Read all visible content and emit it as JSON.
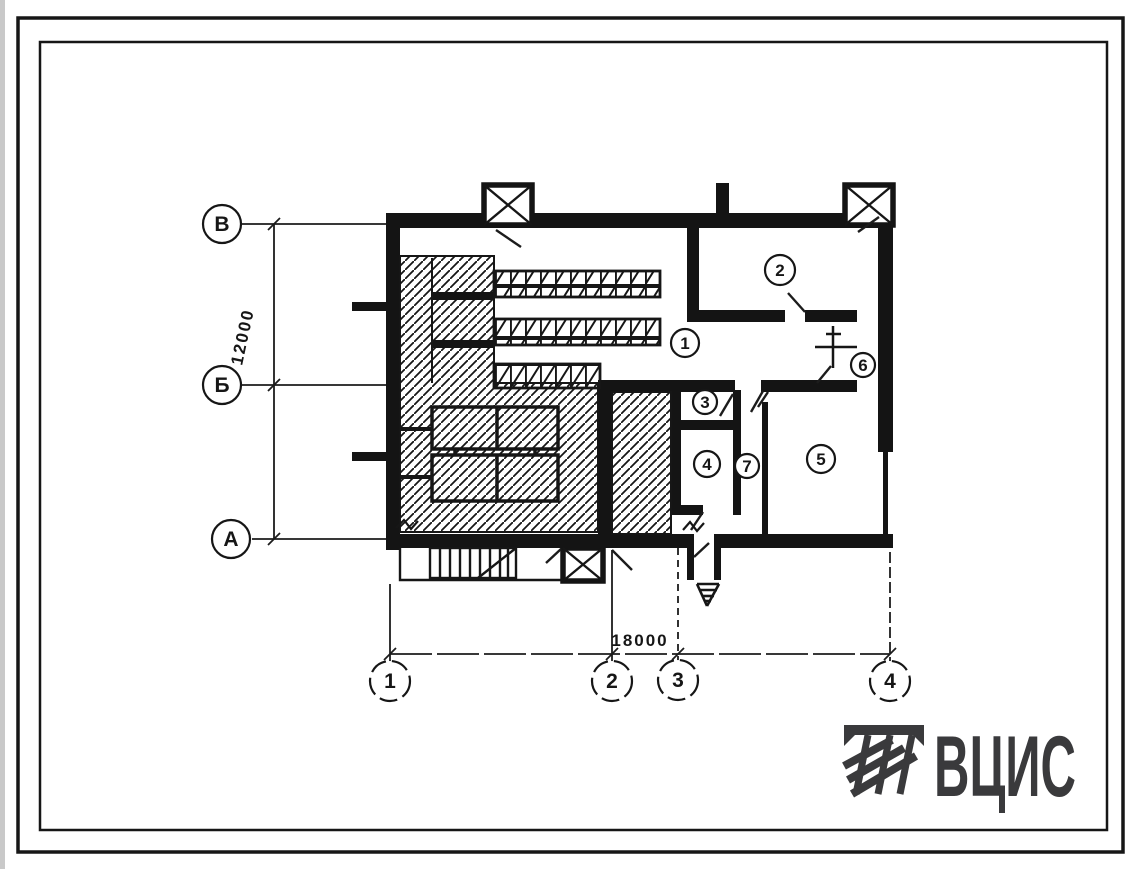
{
  "colors": {
    "ink": "#161616",
    "paper": "#ffffff",
    "logo": "#3a3a3c"
  },
  "plan": {
    "axis_rows": [
      {
        "label": "В"
      },
      {
        "label": "Б"
      },
      {
        "label": "А"
      }
    ],
    "axis_cols": [
      {
        "label": "1"
      },
      {
        "label": "2"
      },
      {
        "label": "3"
      },
      {
        "label": "4"
      }
    ],
    "dim_vertical": "12000",
    "dim_horizontal": "18000",
    "rooms": [
      {
        "n": "1"
      },
      {
        "n": "2"
      },
      {
        "n": "3"
      },
      {
        "n": "4"
      },
      {
        "n": "5"
      },
      {
        "n": "6"
      },
      {
        "n": "7"
      }
    ]
  },
  "logo": {
    "text": "ВЦИС"
  }
}
